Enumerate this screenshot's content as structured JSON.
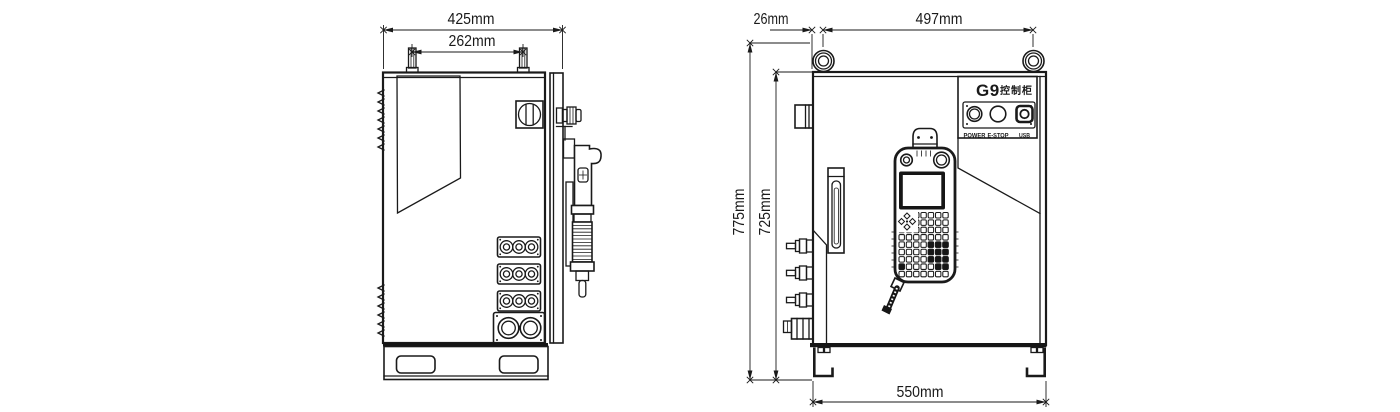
{
  "colors": {
    "line": "#1a1a1a",
    "background": "#ffffff",
    "dark_fill": "#161616"
  },
  "side_view": {
    "dims": {
      "total_width": "425mm",
      "lug_spacing": "262mm"
    }
  },
  "front_view": {
    "dims": {
      "eye_offset": "26mm",
      "eye_spacing": "497mm",
      "total_height": "775mm",
      "body_height": "725mm",
      "base_width": "550mm"
    },
    "nameplate": {
      "model": "G9",
      "type_label": "控制柜"
    },
    "control_plate": {
      "labels": [
        "POWER",
        "E-STOP",
        "USB"
      ]
    }
  }
}
